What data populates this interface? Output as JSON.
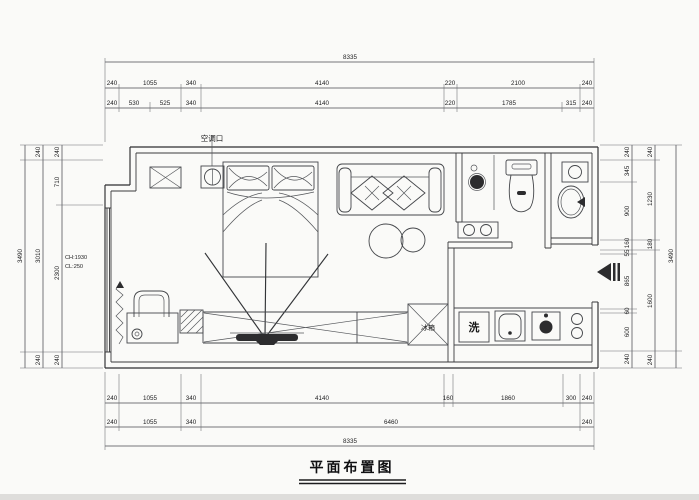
{
  "title": "平面布置图",
  "labels": {
    "ac_vent": "空调口",
    "washing_machine": "洗",
    "fridge": "冰箱",
    "window_note_1": "CH:1930",
    "window_note_2": "CL:250"
  },
  "dimensions": {
    "top": {
      "overall": "8335",
      "row2": [
        "240",
        "1055",
        "340",
        "4140",
        "220",
        "2100",
        "240"
      ],
      "row3": [
        "240",
        "530",
        "525",
        "340",
        "4140",
        "220",
        "1785",
        "315",
        "240"
      ]
    },
    "bottom": {
      "row1": [
        "240",
        "1055",
        "340",
        "4140",
        "160",
        "1860",
        "300",
        "240"
      ],
      "row2": [
        "240",
        "1055",
        "340",
        "6460",
        "240"
      ],
      "overall": "8335"
    },
    "left": {
      "overall": "3490",
      "mid": [
        "240",
        "3010",
        "240"
      ],
      "inner": [
        "240",
        "710",
        "2300",
        "240"
      ]
    },
    "right": {
      "overall": "3490",
      "outer": [
        "240",
        "1230",
        "180",
        "1600",
        "240"
      ],
      "inner": [
        "240",
        "345",
        "900",
        "160",
        "55",
        "865",
        "60",
        "600",
        "240"
      ]
    }
  }
}
